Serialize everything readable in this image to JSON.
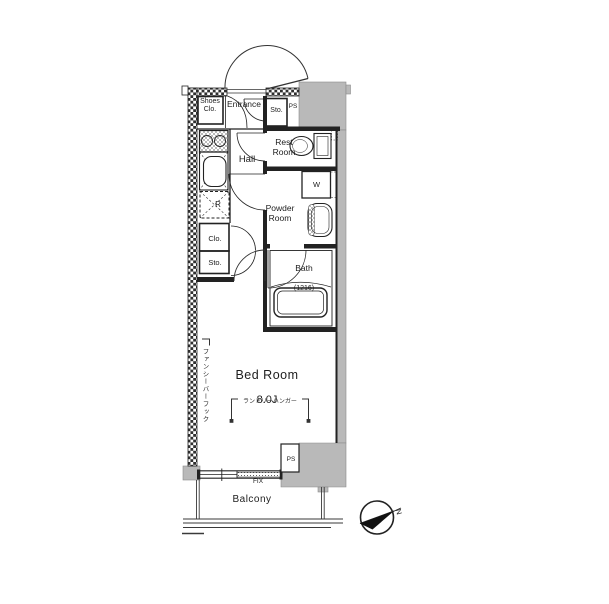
{
  "plan": {
    "rooms": {
      "shoes_closet": {
        "line1": "Shoes",
        "line2": "Clo."
      },
      "entrance": {
        "label": "Entrance"
      },
      "storage_top": {
        "label": "Sto."
      },
      "pipe_shaft_top": {
        "label": "PS"
      },
      "rest_room": {
        "line1": "Rest",
        "line2": "Room"
      },
      "hall": {
        "label": "Hall"
      },
      "washer": {
        "label": "W"
      },
      "powder_room": {
        "line1": "Powder",
        "line2": "Room"
      },
      "refrigerator": {
        "label": "R"
      },
      "closet": {
        "label": "Clo."
      },
      "storage": {
        "label": "Sto."
      },
      "bath": {
        "name": "Bath",
        "size": "(1216)"
      },
      "bedroom": {
        "name": "Bed Room",
        "size": "8.0J"
      },
      "pipe_shaft_bottom": {
        "label": "PS"
      },
      "balcony": {
        "label": "Balcony"
      }
    },
    "annotations": {
      "laundry_hanger": "ランドリーハンガー",
      "fancy_bar_hook": "ファンシーバーフック",
      "fixed_window": "FIX",
      "north": "N"
    },
    "colors": {
      "wall_gray": "#b9b9b9",
      "line": "#222222"
    }
  }
}
